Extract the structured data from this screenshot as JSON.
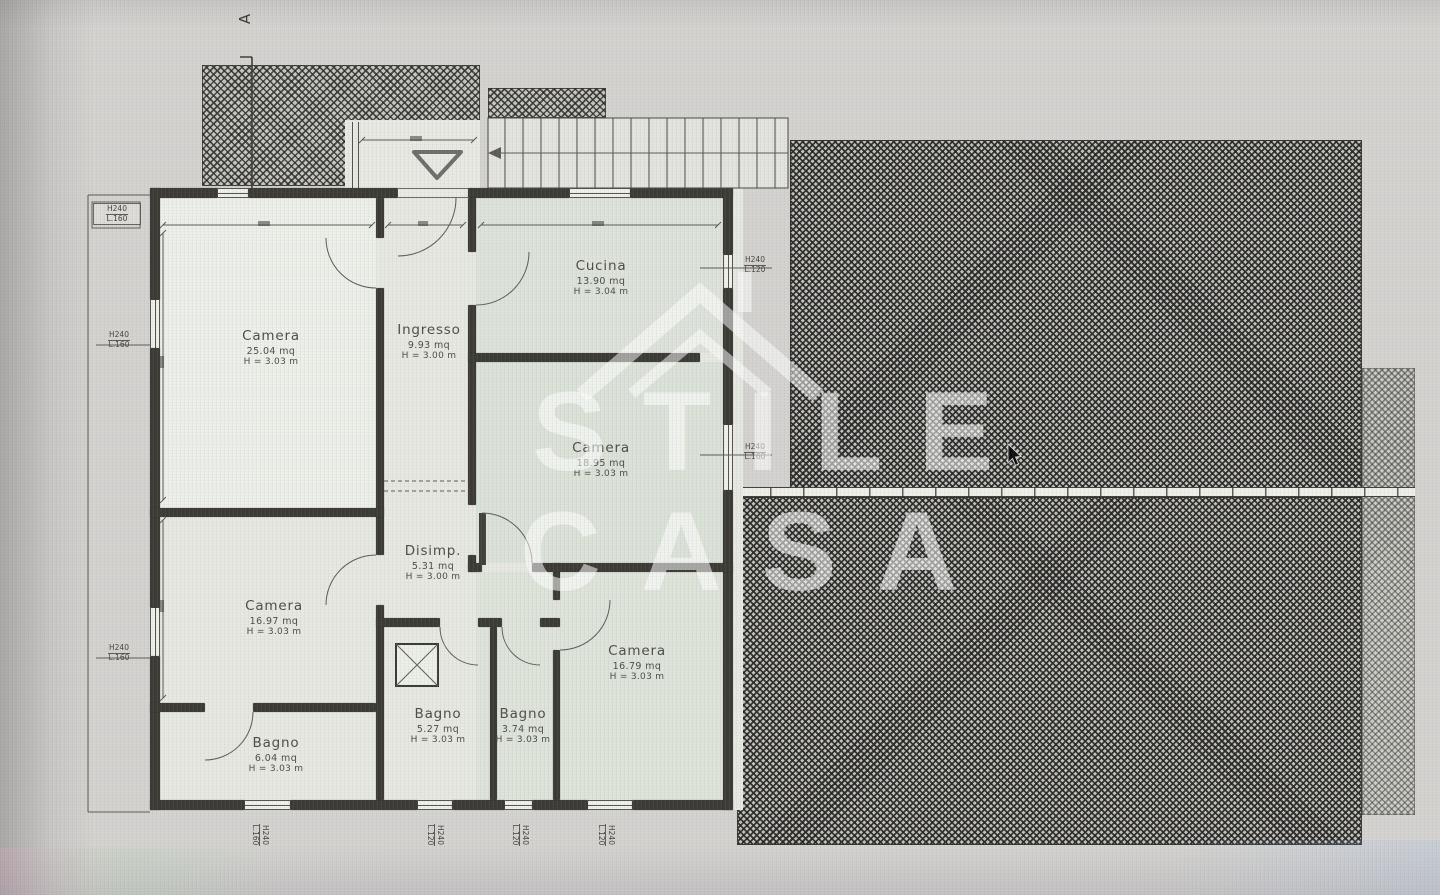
{
  "section_marker": {
    "label": "A"
  },
  "watermark": {
    "line1": "STILE",
    "line2": "CASA",
    "icon": "house-roof-icon"
  },
  "rooms": [
    {
      "name": "Camera",
      "area": "25.04 mq",
      "height": "H = 3.03 m"
    },
    {
      "name": "Ingresso",
      "area": "9.93 mq",
      "height": "H = 3.00 m"
    },
    {
      "name": "Cucina",
      "area": "13.90 mq",
      "height": "H = 3.04 m"
    },
    {
      "name": "Camera",
      "area": "18.95 mq",
      "height": "H = 3.03 m"
    },
    {
      "name": "Disimp.",
      "area": "5.31 mq",
      "height": "H = 3.00 m"
    },
    {
      "name": "Camera",
      "area": "16.97 mq",
      "height": "H = 3.03 m"
    },
    {
      "name": "Camera",
      "area": "16.79 mq",
      "height": "H = 3.03 m"
    },
    {
      "name": "Bagno",
      "area": "6.04 mq",
      "height": "H = 3.03 m"
    },
    {
      "name": "Bagno",
      "area": "5.27 mq",
      "height": "H = 3.03 m"
    },
    {
      "name": "Bagno",
      "area": "3.74 mq",
      "height": "H = 3.03 m"
    }
  ],
  "window_tags": [
    {
      "h": "H240",
      "l": "L.160"
    },
    {
      "h": "H240",
      "l": "L.160"
    },
    {
      "h": "H240",
      "l": "L.120"
    },
    {
      "h": "H240",
      "l": "L.160"
    },
    {
      "h": "H240",
      "l": "L.160"
    },
    {
      "h": "H240",
      "l": "L.160"
    },
    {
      "h": "H240",
      "l": "L.120"
    },
    {
      "h": "H240",
      "l": "L.120"
    },
    {
      "h": "H240",
      "l": "L.120"
    }
  ],
  "colors": {
    "wall": "#3b3a35",
    "paper": "#d4d3d0",
    "room_fill": "#e6e8e1",
    "hatch_base": "#c6c6c1",
    "watermark": "#ffffff"
  }
}
